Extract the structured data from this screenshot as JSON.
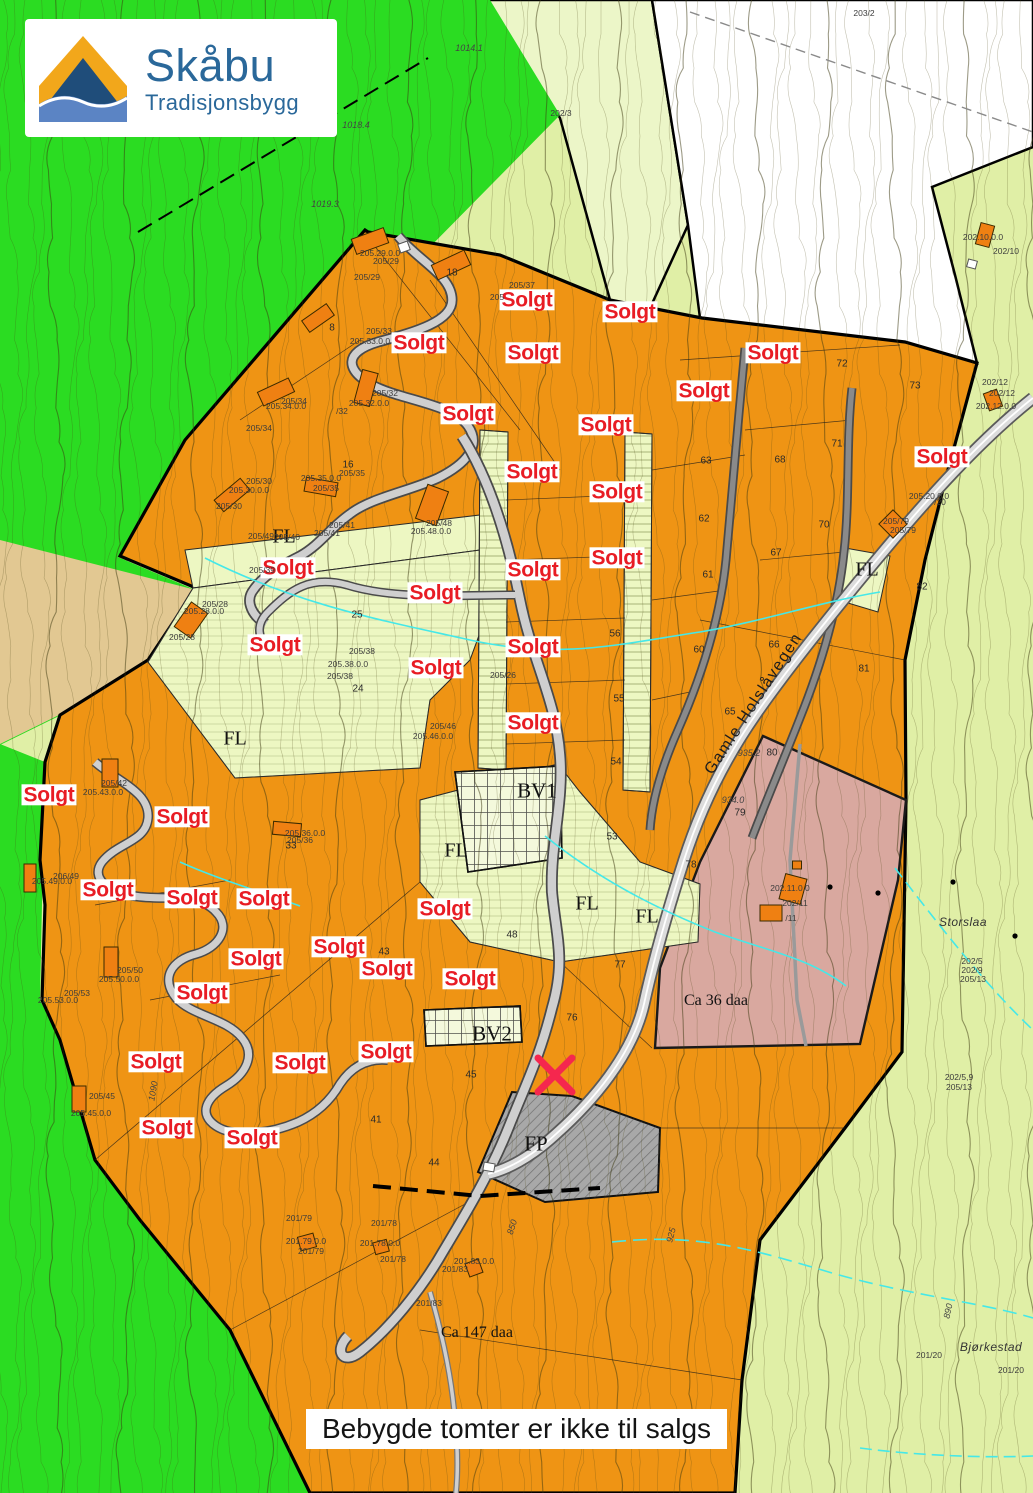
{
  "logo": {
    "title": "Skåbu",
    "subtitle": "Tradisjonsbygg"
  },
  "banner": {
    "text": "Bebygde tomter er ikke til salgs"
  },
  "colors": {
    "bright_green": "#2bdc22",
    "pale_green": "#e0efa6",
    "wedge_green": "#ecf6c8",
    "white_zone": "#ffffff",
    "orange": "#ef9414",
    "fl_strip": "#edf7c2",
    "tan": "#e2c892",
    "pink": "#d9a89f",
    "road": "#cfcfcf",
    "sold_red": "#e81c24",
    "stream": "#45e8e8",
    "marker_red": "#f5274e",
    "building": "#ef8012"
  },
  "map": {
    "sold_label": "Solgt",
    "sold_positions": [
      [
        527,
        300
      ],
      [
        630,
        312
      ],
      [
        419,
        343
      ],
      [
        533,
        353
      ],
      [
        773,
        353
      ],
      [
        704,
        391
      ],
      [
        468,
        414
      ],
      [
        606,
        425
      ],
      [
        942,
        457
      ],
      [
        532,
        472
      ],
      [
        617,
        492
      ],
      [
        288,
        568
      ],
      [
        617,
        558
      ],
      [
        533,
        570
      ],
      [
        435,
        593
      ],
      [
        275,
        645
      ],
      [
        533,
        647
      ],
      [
        436,
        668
      ],
      [
        533,
        723
      ],
      [
        49,
        795
      ],
      [
        182,
        817
      ],
      [
        108,
        890
      ],
      [
        192,
        898
      ],
      [
        264,
        899
      ],
      [
        445,
        909
      ],
      [
        339,
        947
      ],
      [
        256,
        959
      ],
      [
        387,
        969
      ],
      [
        470,
        979
      ],
      [
        202,
        993
      ],
      [
        386,
        1052
      ],
      [
        156,
        1062
      ],
      [
        300,
        1063
      ],
      [
        167,
        1128
      ],
      [
        252,
        1138
      ]
    ],
    "fl_label": "FL",
    "fl_positions": [
      [
        284,
        537
      ],
      [
        235,
        739
      ],
      [
        456,
        851
      ],
      [
        587,
        904
      ],
      [
        647,
        917
      ],
      [
        867,
        570
      ]
    ],
    "zone_labels": [
      {
        "t": "BV1",
        "x": 537,
        "y": 791
      },
      {
        "t": "BV2",
        "x": 492,
        "y": 1034
      },
      {
        "t": "FP",
        "x": 536,
        "y": 1144
      }
    ],
    "area_labels": [
      {
        "t": "Ca 36 daa",
        "x": 716,
        "y": 1001
      },
      {
        "t": "Ca 147 daa",
        "x": 477,
        "y": 1333
      }
    ],
    "place_labels": [
      {
        "t": "Storslaa",
        "x": 963,
        "y": 922
      },
      {
        "t": "Bjørkestad",
        "x": 991,
        "y": 1347
      }
    ],
    "road_label": {
      "t": "Gamle Holslåvegen",
      "x": 754,
      "y": 704,
      "rot": -57
    },
    "elevation_labels": [
      {
        "t": "1014.1",
        "x": 469,
        "y": 48,
        "rot": 0
      },
      {
        "t": "1018.4",
        "x": 356,
        "y": 125,
        "rot": 0
      },
      {
        "t": "1019.3",
        "x": 325,
        "y": 204,
        "rot": 0
      },
      {
        "t": "935.2",
        "x": 749,
        "y": 753,
        "rot": 0
      },
      {
        "t": "934.0",
        "x": 733,
        "y": 800,
        "rot": 0
      },
      {
        "t": "890",
        "x": 948,
        "y": 1311,
        "rot": -78
      },
      {
        "t": "925",
        "x": 671,
        "y": 1235,
        "rot": -75
      },
      {
        "t": "850",
        "x": 512,
        "y": 1227,
        "rot": -72
      },
      {
        "t": "1090",
        "x": 153,
        "y": 1091,
        "rot": -80
      }
    ],
    "lot_numbers": [
      {
        "t": "8",
        "x": 332,
        "y": 328
      },
      {
        "t": "18",
        "x": 452,
        "y": 273
      },
      {
        "t": "16",
        "x": 348,
        "y": 465
      },
      {
        "t": "24",
        "x": 358,
        "y": 689
      },
      {
        "t": "25",
        "x": 357,
        "y": 615
      },
      {
        "t": "33",
        "x": 291,
        "y": 846
      },
      {
        "t": "41",
        "x": 376,
        "y": 1120
      },
      {
        "t": "43",
        "x": 384,
        "y": 952
      },
      {
        "t": "44",
        "x": 434,
        "y": 1163
      },
      {
        "t": "45",
        "x": 471,
        "y": 1075
      },
      {
        "t": "48",
        "x": 512,
        "y": 935
      },
      {
        "t": "53",
        "x": 612,
        "y": 837
      },
      {
        "t": "54",
        "x": 616,
        "y": 762
      },
      {
        "t": "55",
        "x": 619,
        "y": 699
      },
      {
        "t": "56",
        "x": 615,
        "y": 634
      },
      {
        "t": "60",
        "x": 699,
        "y": 650
      },
      {
        "t": "61",
        "x": 708,
        "y": 575
      },
      {
        "t": "62",
        "x": 704,
        "y": 519
      },
      {
        "t": "63",
        "x": 706,
        "y": 461
      },
      {
        "t": "65",
        "x": 730,
        "y": 712
      },
      {
        "t": "66",
        "x": 774,
        "y": 645
      },
      {
        "t": "67",
        "x": 776,
        "y": 553
      },
      {
        "t": "68",
        "x": 780,
        "y": 460
      },
      {
        "t": "70",
        "x": 824,
        "y": 525
      },
      {
        "t": "71",
        "x": 837,
        "y": 444
      },
      {
        "t": "72",
        "x": 842,
        "y": 364
      },
      {
        "t": "73",
        "x": 915,
        "y": 386
      },
      {
        "t": "76",
        "x": 572,
        "y": 1018
      },
      {
        "t": "77",
        "x": 620,
        "y": 965
      },
      {
        "t": "78",
        "x": 691,
        "y": 865
      },
      {
        "t": "79",
        "x": 740,
        "y": 813
      },
      {
        "t": "80",
        "x": 772,
        "y": 753
      },
      {
        "t": "81",
        "x": 864,
        "y": 669
      },
      {
        "t": "82",
        "x": 922,
        "y": 587
      }
    ],
    "parcel_labels": [
      {
        "t": "203/2",
        "x": 864,
        "y": 13
      },
      {
        "t": "202/3",
        "x": 561,
        "y": 113
      },
      {
        "t": "202.10.0.0",
        "x": 983,
        "y": 237
      },
      {
        "t": "202/10",
        "x": 1006,
        "y": 251
      },
      {
        "t": "205.29.0.0",
        "x": 380,
        "y": 253
      },
      {
        "t": "205/29",
        "x": 386,
        "y": 261
      },
      {
        "t": "205/29",
        "x": 367,
        "y": 277
      },
      {
        "t": "205/37",
        "x": 522,
        "y": 285
      },
      {
        "t": "205",
        "x": 497,
        "y": 297
      },
      {
        "t": "205/33",
        "x": 379,
        "y": 331
      },
      {
        "t": "205.33.0.0",
        "x": 370,
        "y": 341
      },
      {
        "t": "205/34",
        "x": 294,
        "y": 401
      },
      {
        "t": "205.34.0.0",
        "x": 286,
        "y": 406
      },
      {
        "t": "205/34",
        "x": 259,
        "y": 428
      },
      {
        "t": "205/32",
        "x": 385,
        "y": 393
      },
      {
        "t": "205.32.0.0",
        "x": 369,
        "y": 403
      },
      {
        "t": "/32",
        "x": 342,
        "y": 411
      },
      {
        "t": "202/12",
        "x": 995,
        "y": 382
      },
      {
        "t": "202/12",
        "x": 1002,
        "y": 393
      },
      {
        "t": "202.12.0.0",
        "x": 996,
        "y": 406
      },
      {
        "t": "205/35",
        "x": 352,
        "y": 473
      },
      {
        "t": "205.35.0.0",
        "x": 321,
        "y": 478
      },
      {
        "t": "205/35",
        "x": 326,
        "y": 488
      },
      {
        "t": "205/30",
        "x": 259,
        "y": 481
      },
      {
        "t": "205.30.0.0",
        "x": 249,
        "y": 490
      },
      {
        "t": "205/30",
        "x": 229,
        "y": 506
      },
      {
        "t": "205/48",
        "x": 439,
        "y": 523
      },
      {
        "t": "205.48.0.0",
        "x": 431,
        "y": 531
      },
      {
        "t": "205/41",
        "x": 342,
        "y": 525
      },
      {
        "t": "205/41",
        "x": 327,
        "y": 533
      },
      {
        "t": "205/40",
        "x": 287,
        "y": 537
      },
      {
        "t": "205/49",
        "x": 261,
        "y": 536
      },
      {
        "t": "205.20.0.0",
        "x": 929,
        "y": 496
      },
      {
        "t": "/20",
        "x": 940,
        "y": 502
      },
      {
        "t": "205/79",
        "x": 896,
        "y": 521
      },
      {
        "t": "205/79",
        "x": 903,
        "y": 530
      },
      {
        "t": "205/28",
        "x": 215,
        "y": 604
      },
      {
        "t": "205.28.0.0",
        "x": 204,
        "y": 611
      },
      {
        "t": "205/28",
        "x": 182,
        "y": 637
      },
      {
        "t": "205/39",
        "x": 262,
        "y": 570
      },
      {
        "t": "205/26",
        "x": 503,
        "y": 675
      },
      {
        "t": "205/38",
        "x": 362,
        "y": 651
      },
      {
        "t": "205.38.0.0",
        "x": 348,
        "y": 664
      },
      {
        "t": "205/38",
        "x": 340,
        "y": 676
      },
      {
        "t": "205/46",
        "x": 443,
        "y": 726
      },
      {
        "t": "205.46.0.0",
        "x": 433,
        "y": 736
      },
      {
        "t": "205/42",
        "x": 114,
        "y": 783
      },
      {
        "t": "205.43.0.0",
        "x": 103,
        "y": 792
      },
      {
        "t": "206/49",
        "x": 66,
        "y": 876
      },
      {
        "t": "205.49.0.0",
        "x": 52,
        "y": 881
      },
      {
        "t": "205.36.0.0",
        "x": 305,
        "y": 833
      },
      {
        "t": "205/36",
        "x": 300,
        "y": 840
      },
      {
        "t": "202.11.0.0",
        "x": 790,
        "y": 888
      },
      {
        "t": "202/11",
        "x": 795,
        "y": 903
      },
      {
        "t": "/11",
        "x": 791,
        "y": 918
      },
      {
        "t": "202/5",
        "x": 972,
        "y": 961
      },
      {
        "t": "202/9",
        "x": 972,
        "y": 970
      },
      {
        "t": "205/13",
        "x": 973,
        "y": 979
      },
      {
        "t": "205/50",
        "x": 130,
        "y": 970
      },
      {
        "t": "205.50.0.0",
        "x": 119,
        "y": 979
      },
      {
        "t": "205/53",
        "x": 77,
        "y": 993
      },
      {
        "t": "205.53.0.0",
        "x": 58,
        "y": 1000
      },
      {
        "t": "202/5,9",
        "x": 959,
        "y": 1077
      },
      {
        "t": "205/13",
        "x": 959,
        "y": 1087
      },
      {
        "t": "205/45",
        "x": 102,
        "y": 1096
      },
      {
        "t": "205.45.0.0",
        "x": 91,
        "y": 1113
      },
      {
        "t": "201/79",
        "x": 299,
        "y": 1218
      },
      {
        "t": "201.79.0.0",
        "x": 306,
        "y": 1241
      },
      {
        "t": "201/79",
        "x": 311,
        "y": 1251
      },
      {
        "t": "201/78",
        "x": 384,
        "y": 1223
      },
      {
        "t": "201.78.0.0",
        "x": 380,
        "y": 1243
      },
      {
        "t": "201/78",
        "x": 393,
        "y": 1259
      },
      {
        "t": "201.83.0.0",
        "x": 474,
        "y": 1261
      },
      {
        "t": "201/83",
        "x": 455,
        "y": 1269
      },
      {
        "t": "201/83",
        "x": 429,
        "y": 1303
      },
      {
        "t": "201/20",
        "x": 929,
        "y": 1355
      },
      {
        "t": "201/20",
        "x": 1011,
        "y": 1370
      }
    ],
    "buildings": [
      {
        "x": 370,
        "y": 241,
        "w": 34,
        "h": 16,
        "r": -20
      },
      {
        "x": 451,
        "y": 265,
        "w": 36,
        "h": 16,
        "r": -25
      },
      {
        "x": 318,
        "y": 318,
        "w": 30,
        "h": 14,
        "r": -35
      },
      {
        "x": 276,
        "y": 392,
        "w": 34,
        "h": 15,
        "r": -25
      },
      {
        "x": 366,
        "y": 388,
        "w": 16,
        "h": 34,
        "r": 15
      },
      {
        "x": 232,
        "y": 495,
        "w": 34,
        "h": 15,
        "r": -40
      },
      {
        "x": 321,
        "y": 487,
        "w": 32,
        "h": 14,
        "r": 10
      },
      {
        "x": 432,
        "y": 505,
        "w": 22,
        "h": 36,
        "r": 20
      },
      {
        "x": 191,
        "y": 620,
        "w": 20,
        "h": 30,
        "r": 35
      },
      {
        "x": 110,
        "y": 773,
        "w": 16,
        "h": 28,
        "r": 0
      },
      {
        "x": 287,
        "y": 829,
        "w": 28,
        "h": 13,
        "r": 5
      },
      {
        "x": 30,
        "y": 878,
        "w": 12,
        "h": 28,
        "r": 0
      },
      {
        "x": 111,
        "y": 962,
        "w": 14,
        "h": 30,
        "r": 0
      },
      {
        "x": 79,
        "y": 1099,
        "w": 14,
        "h": 26,
        "r": 0
      },
      {
        "x": 307,
        "y": 1242,
        "w": 16,
        "h": 14,
        "r": -15
      },
      {
        "x": 381,
        "y": 1247,
        "w": 14,
        "h": 12,
        "r": -15
      },
      {
        "x": 474,
        "y": 1268,
        "w": 14,
        "h": 14,
        "r": -20
      },
      {
        "x": 793,
        "y": 889,
        "w": 22,
        "h": 26,
        "r": 15
      },
      {
        "x": 771,
        "y": 913,
        "w": 22,
        "h": 16,
        "r": 0
      },
      {
        "x": 985,
        "y": 235,
        "w": 14,
        "h": 22,
        "r": 15
      },
      {
        "x": 993,
        "y": 400,
        "w": 14,
        "h": 18,
        "r": -20
      },
      {
        "x": 893,
        "y": 524,
        "w": 20,
        "h": 20,
        "r": 45
      },
      {
        "x": 797,
        "y": 865,
        "w": 9,
        "h": 8,
        "r": 0
      }
    ],
    "white_buildings": [
      {
        "x": 404,
        "y": 247,
        "w": 10,
        "h": 9,
        "r": -20
      },
      {
        "x": 489,
        "y": 1167,
        "w": 11,
        "h": 8,
        "r": 10
      },
      {
        "x": 972,
        "y": 264,
        "w": 9,
        "h": 8,
        "r": 15
      }
    ],
    "marker": {
      "x": 555,
      "y": 1075
    }
  }
}
